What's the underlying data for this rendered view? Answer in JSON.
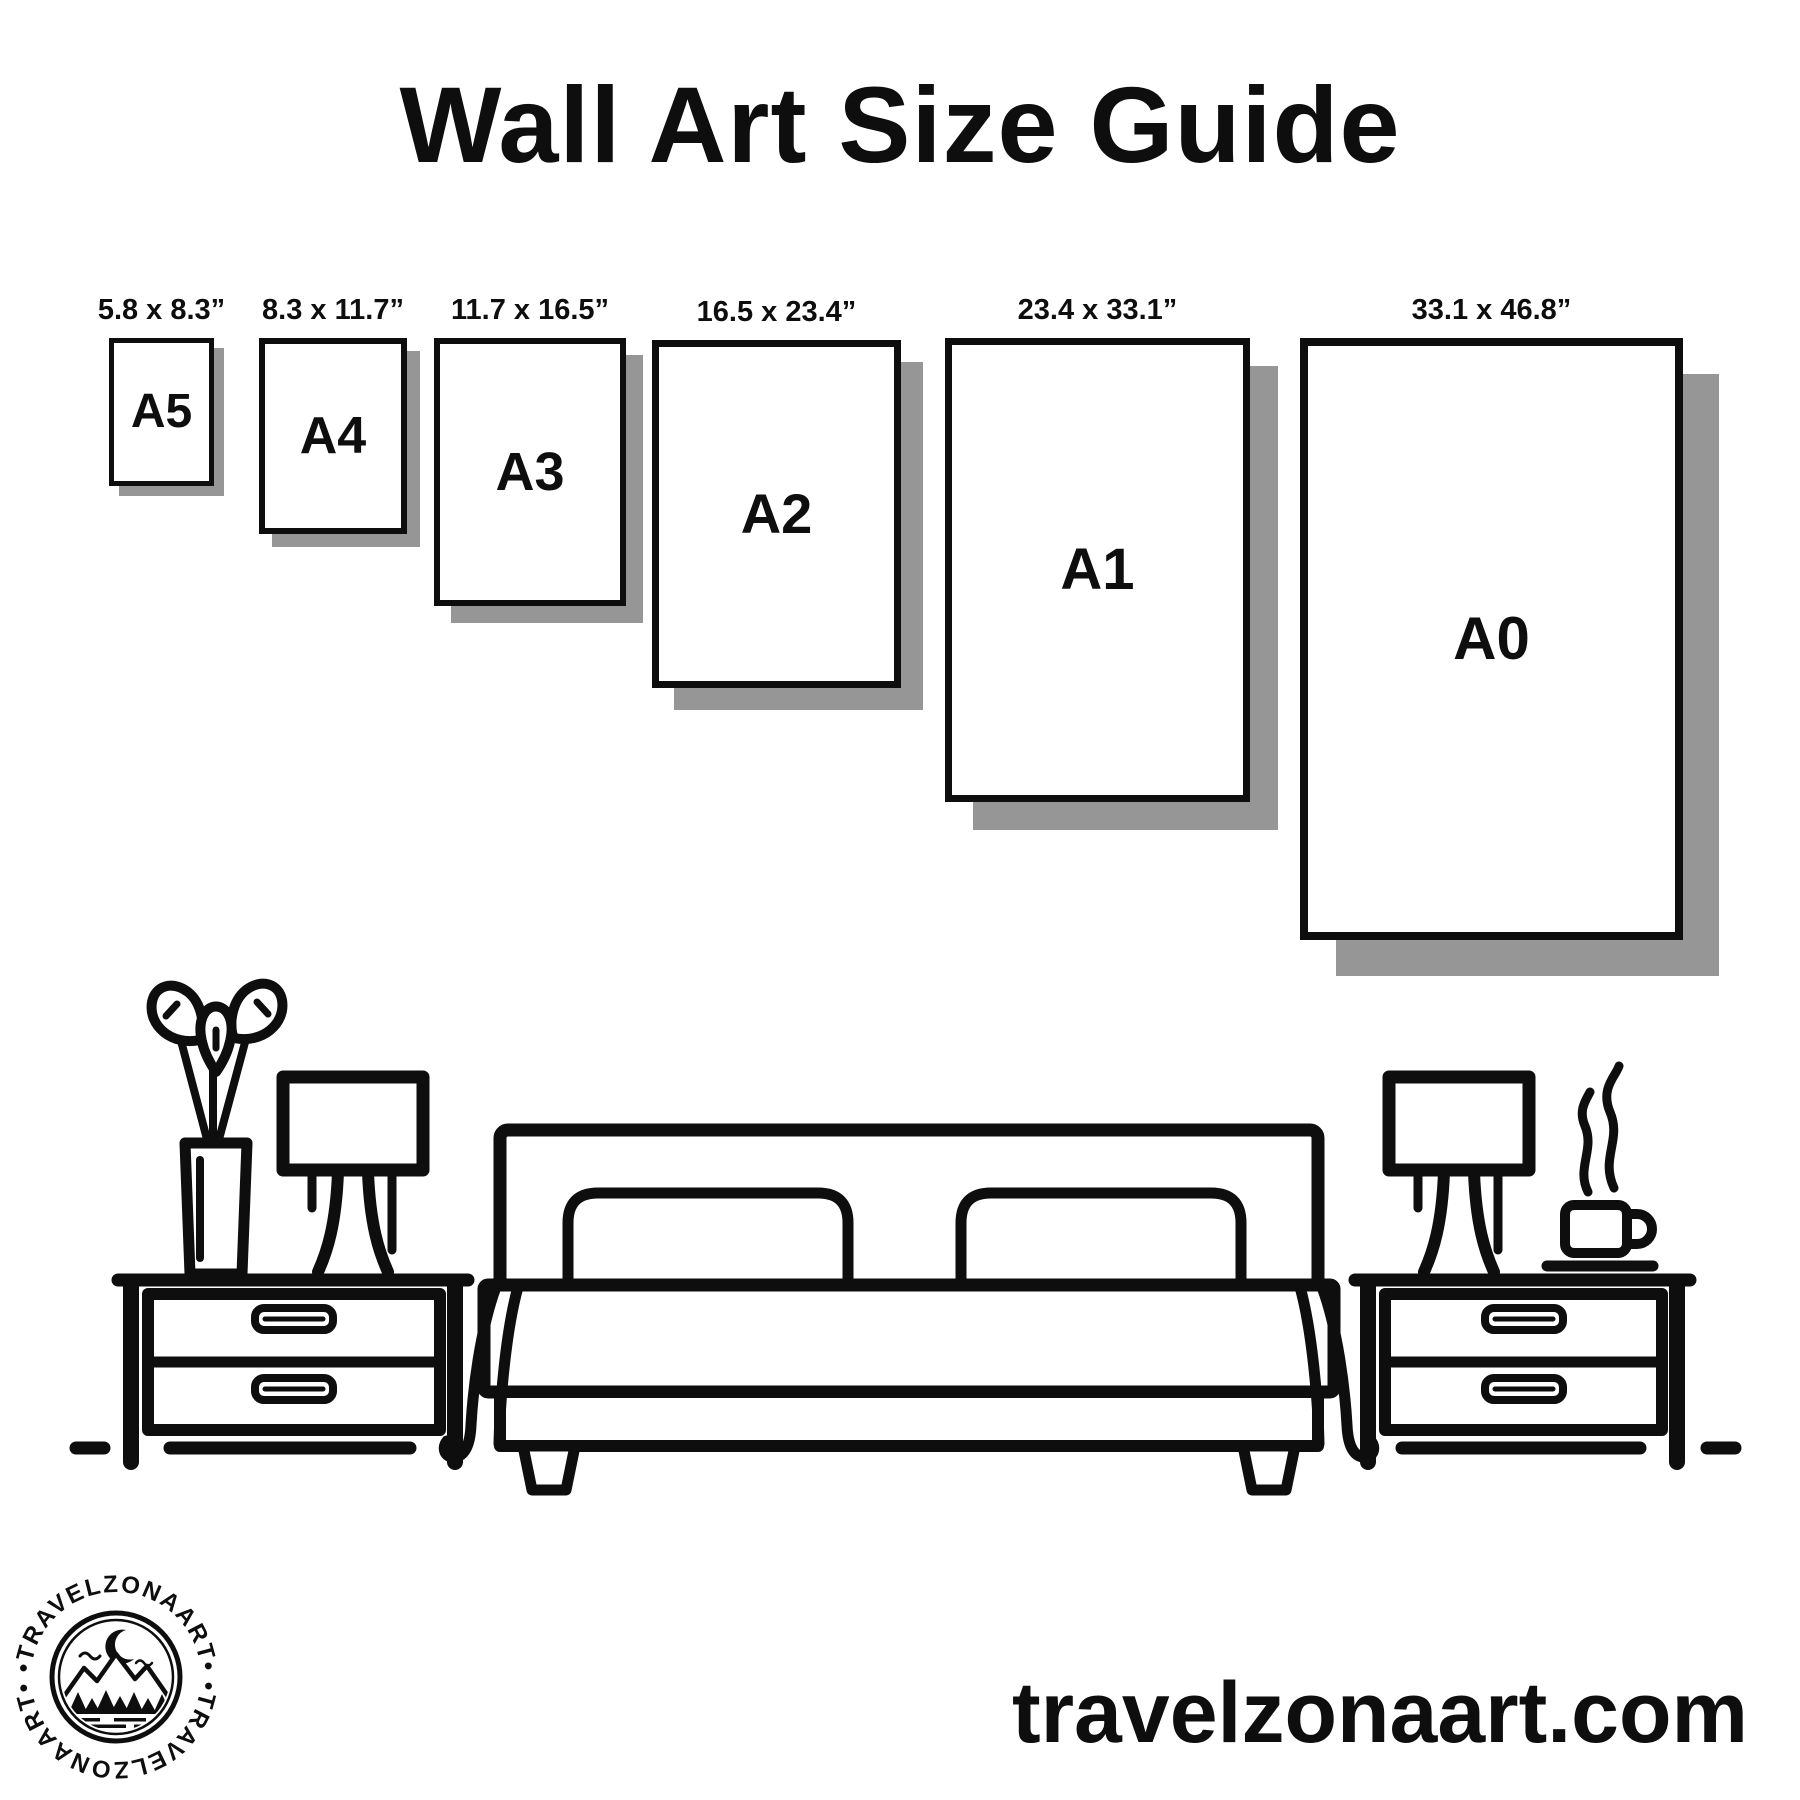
{
  "title": "Wall Art Size Guide",
  "website": "travelzonaart.com",
  "logo": {
    "brand": "TRAVELZONAART",
    "arc_text": "•TRAVELZONAART•"
  },
  "frames": [
    {
      "label": "A5",
      "size": "5.8 x 8.3”"
    },
    {
      "label": "A4",
      "size": "8.3 x 11.7”"
    },
    {
      "label": "A3",
      "size": "11.7 x 16.5”"
    },
    {
      "label": "A2",
      "size": "16.5 x 23.4”"
    },
    {
      "label": "A1",
      "size": "23.4 x 33.1”"
    },
    {
      "label": "A0",
      "size": "33.1 x 46.8”"
    }
  ],
  "colors": {
    "ink": "#0e0e0e",
    "shadow": "#969696",
    "background": "#ffffff"
  },
  "scene_icons": [
    "plant-vase-icon",
    "table-lamp-icon",
    "nightstand-icon",
    "bed-icon",
    "coffee-cup-icon",
    "steam-icon",
    "ground-line",
    "logo-badge"
  ]
}
